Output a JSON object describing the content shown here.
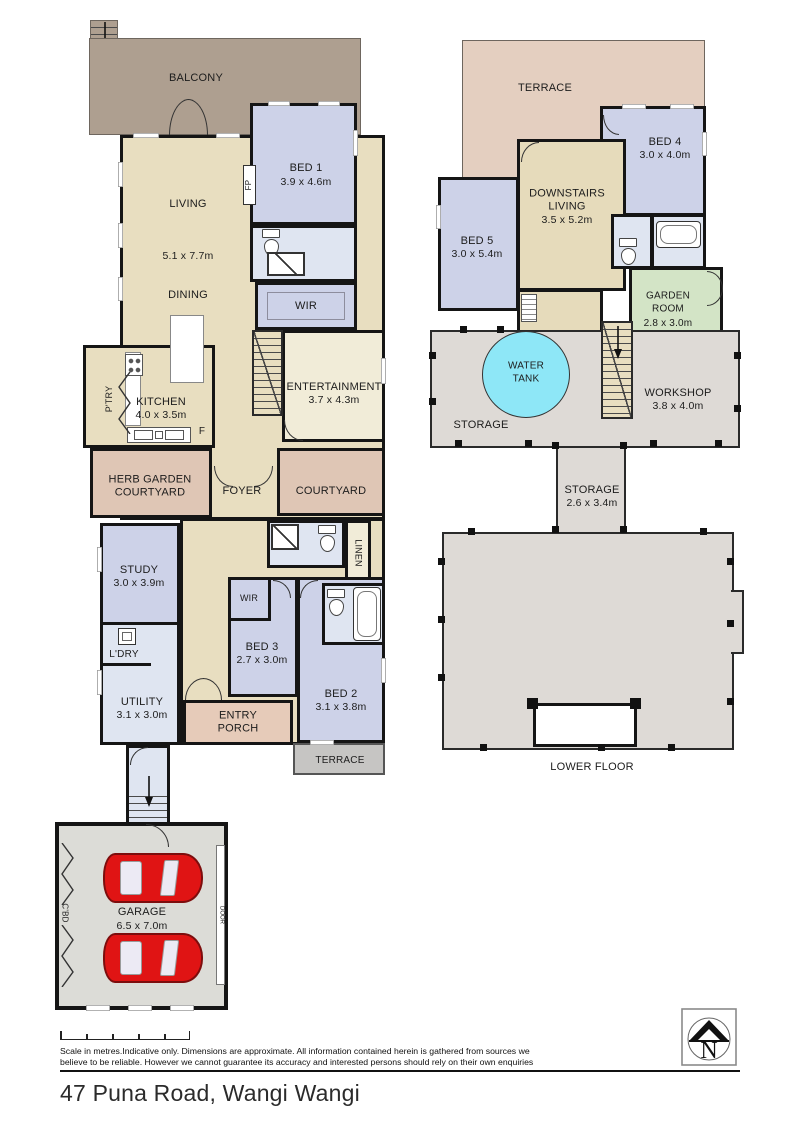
{
  "colors": {
    "wall": "#151515",
    "beige": "#e8dec0",
    "lavender": "#cdd2e8",
    "paleblue": "#dfe5f1",
    "cream": "#f1ecd8",
    "pink": "#dfc6b5",
    "porch": "#e6cbb9",
    "terracegray": "#c6c5c3",
    "garagegray": "#dcdcd7",
    "balcony": "#ae9f90",
    "terracetan": "#e4cfc0",
    "khaki": "#e6dbbb",
    "green": "#d3e4c6",
    "cyan": "#8ee7f7",
    "storagegray": "#dedad6",
    "car": "#e01414"
  },
  "upper": {
    "balcony": "BALCONY",
    "living": "LIVING",
    "living_dims": "5.1 x 7.7m",
    "dining": "DINING",
    "fp": "FP",
    "bed1": "BED 1",
    "bed1_dims": "3.9 x 4.6m",
    "wir1": "WIR",
    "entertainment": "ENTERTAINMENT",
    "entertainment_dims": "3.7 x 4.3m",
    "kitchen": "KITCHEN",
    "kitchen_dims": "4.0 x 3.5m",
    "pantry": "P'TRY",
    "fridge": "F",
    "herb_courtyard": "HERB GARDEN\nCOURTYARD",
    "foyer": "FOYER",
    "courtyard": "COURTYARD",
    "study": "STUDY",
    "study_dims": "3.0 x 3.9m",
    "linen": "LINEN",
    "wir2": "WIR",
    "bed3": "BED 3",
    "bed3_dims": "2.7 x 3.0m",
    "bed2": "BED 2",
    "bed2_dims": "3.1 x 3.8m",
    "laundry": "L'DRY",
    "utility": "UTILITY",
    "utility_dims": "3.1 x 3.0m",
    "entry_porch": "ENTRY\nPORCH",
    "terrace": "TERRACE",
    "garage": "GARAGE",
    "garage_dims": "6.5 x 7.0m",
    "cupboard": "C'BD",
    "garage_door": "DOOR"
  },
  "lower": {
    "terrace": "TERRACE",
    "bed4": "BED 4",
    "bed4_dims": "3.0 x 4.0m",
    "downstairs_living": "DOWNSTAIRS\nLIVING",
    "downstairs_living_dims": "3.5 x 5.2m",
    "bed5": "BED 5",
    "bed5_dims": "3.0 x 5.4m",
    "garden_room": "GARDEN\nROOM",
    "garden_room_dims": "2.8 x 3.0m",
    "water_tank": "WATER\nTANK",
    "storage1": "STORAGE",
    "workshop": "WORKSHOP",
    "workshop_dims": "3.8 x 4.0m",
    "storage2": "STORAGE",
    "storage2_dims": "2.6 x 3.4m",
    "floor_name": "LOWER FLOOR"
  },
  "footer": {
    "disclaimer_line1": "Scale in metres.Indicative only. Dimensions are approximate. All information contained herein is gathered from sources we",
    "disclaimer_line2": "believe to be reliable. However we cannot guarantee its accuracy and interested persons should rely on their own enquiries",
    "address": "47 Puna Road, Wangi Wangi",
    "north": "N"
  }
}
